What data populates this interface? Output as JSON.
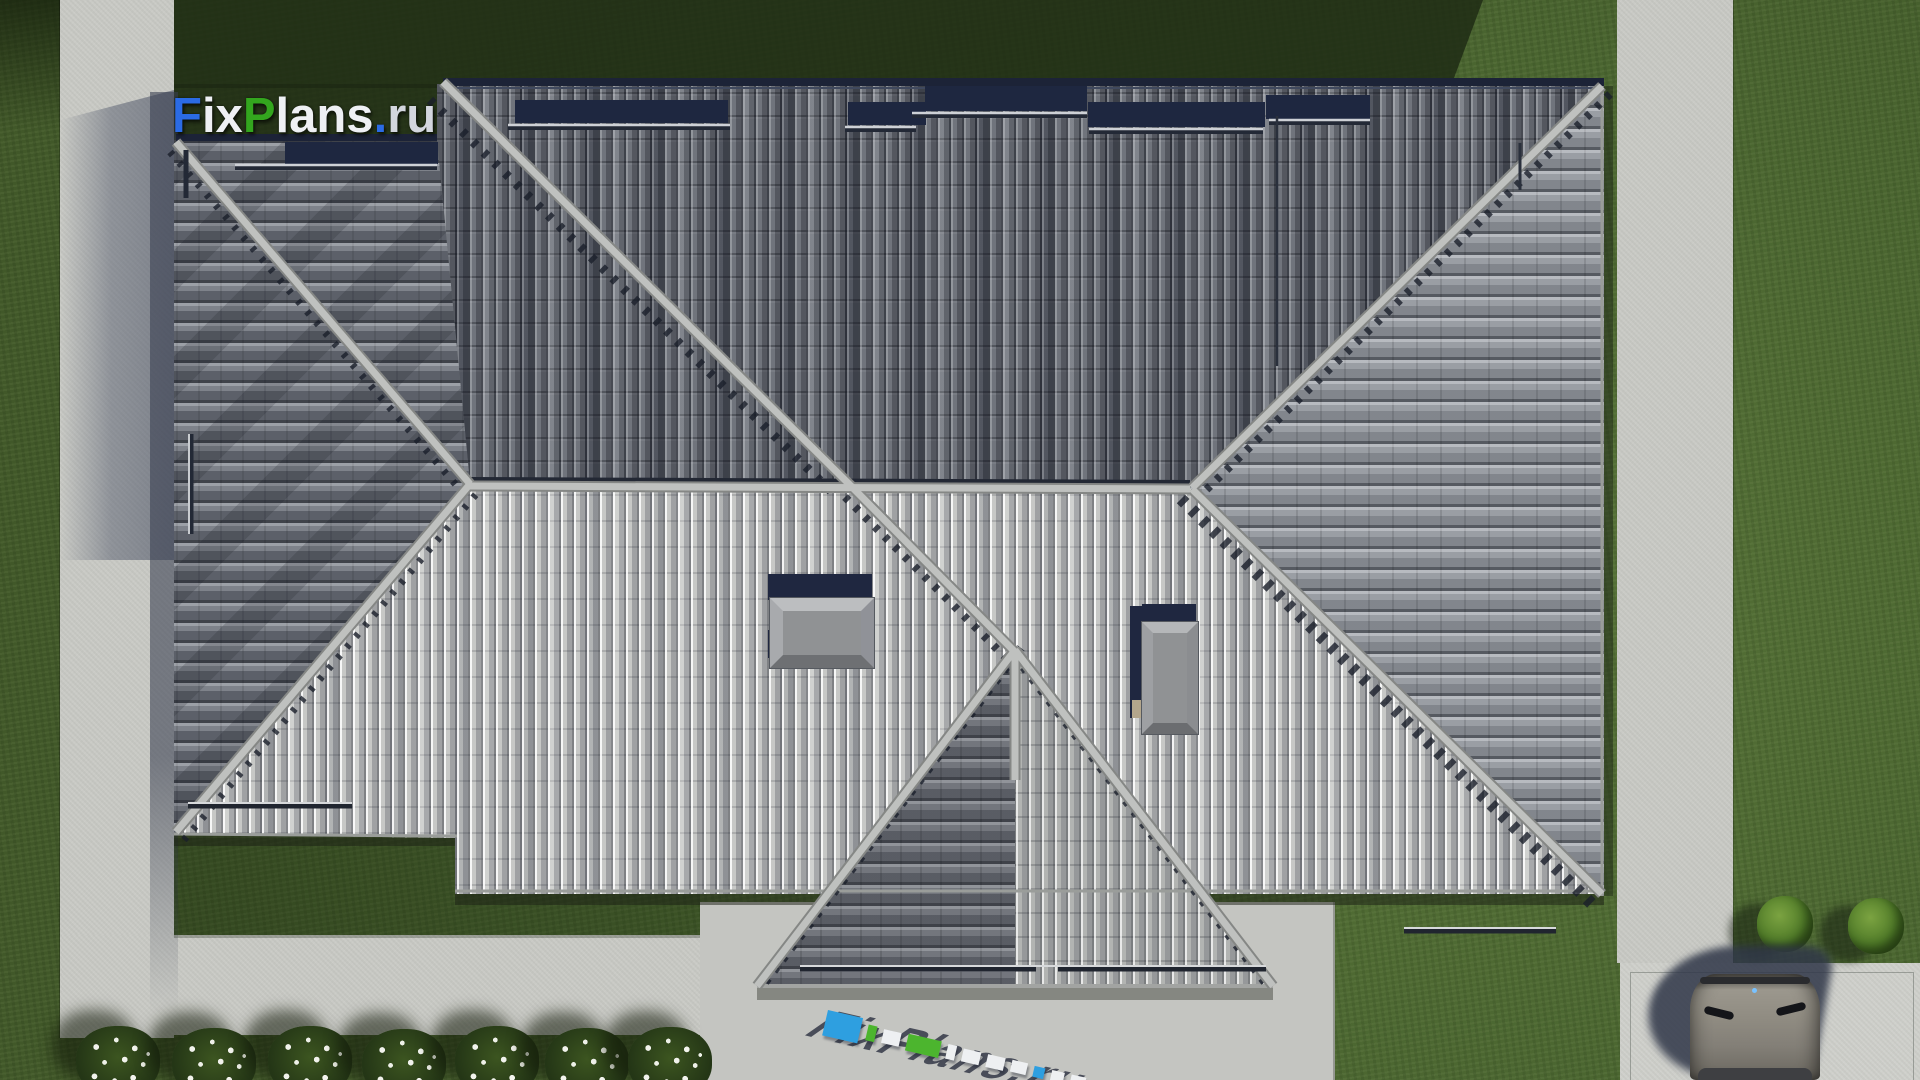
{
  "watermark": {
    "full": "FixPlans.ru",
    "f": "F",
    "ix": "ix",
    "p": "P",
    "lans": "lans",
    "dot": ".",
    "ru": "ru",
    "colors": {
      "blue": "#2b6be4",
      "green": "#33a61e",
      "white": "#eef0f4"
    }
  },
  "scene": {
    "type": "aerial-3d-render",
    "subject": "Top-down 3D render of a single-family house hip roof with gray tiles, lawn, concrete walkways, rear terrace, driveway with parked car, flower bushes and shrubs",
    "objects": [
      "hip-roof",
      "ridge-caps",
      "snow-guard-bars",
      "navy-eave-tile-bands",
      "skylight-box-wide",
      "skylight-box-tall",
      "lightning-rods",
      "lawn",
      "lawn-shadow",
      "walkway-left",
      "walkway-right",
      "walkway-bottom",
      "terrace",
      "driveway-pad",
      "car",
      "driveway-shrubs",
      "flower-bushes",
      "3d-logo-on-pavement",
      "logo-watermark"
    ],
    "palette": {
      "grass": "#4e6a31",
      "grass_shadow": "#1d2913",
      "walkway": "#c9cac5",
      "terrace": "#c4c5c1",
      "driveway": "#cfd0cb",
      "roof_upper_slope": "#6e727a",
      "roof_lower_slope": "#c6c7c5",
      "roof_east_slope": "#999da3",
      "roof_west_wing": "#7e828a",
      "ridge_cap": "#b3b5b3",
      "eave_tiles_navy": "#1e2740",
      "skylight": "#909294",
      "car": "#8e8a80",
      "car_shadow": "#39415a",
      "flowers": "#f1f2ec",
      "shrub": "#4f7a28"
    }
  }
}
